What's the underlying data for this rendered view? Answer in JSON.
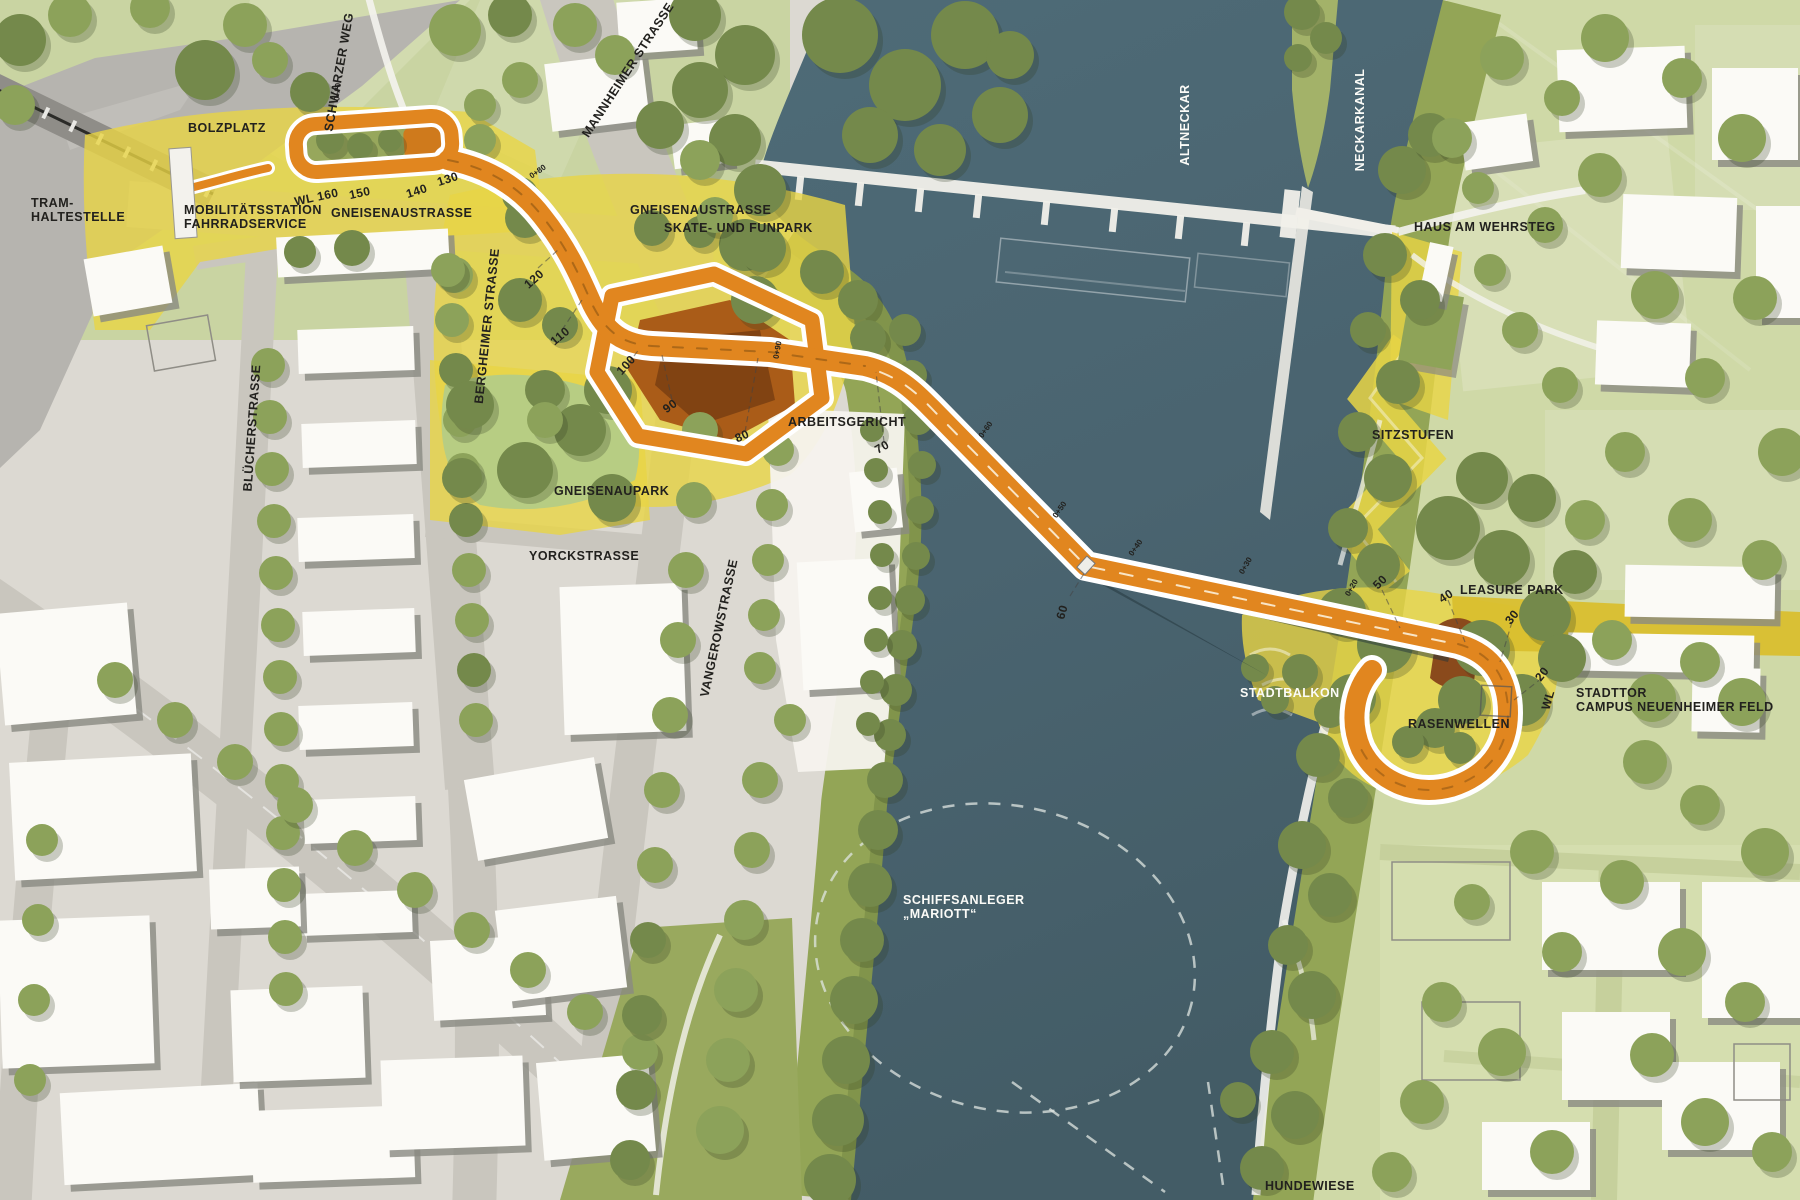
{
  "places": {
    "tram_haltestelle": {
      "line1": "TRAM-",
      "line2": "HALTESTELLE"
    },
    "bolzplatz": {
      "text": "BOLZPLATZ"
    },
    "mobilitaetsstation": {
      "line1": "MOBILITÄTSSTATION",
      "line2": "FAHRRADSERVICE"
    },
    "gneisenaustrasse_west": {
      "text": "GNEISENAUSTRASSE"
    },
    "gneisenaustrasse_east": {
      "text": "GNEISENAUSTRASSE"
    },
    "skate_funpark": {
      "text": "SKATE- UND FUNPARK"
    },
    "schwarzer_weg": {
      "text": "SCHWARZER WEG"
    },
    "mannheimer_strasse": {
      "text": "MANNHEIMER STRASSE"
    },
    "bergheimer_strasse": {
      "text": "BERGHEIMER STRASSE"
    },
    "bluecherstrasse": {
      "text": "BLÜCHERSTRASSE"
    },
    "vangerowstrasse": {
      "text": "VANGEROWSTRASSE"
    },
    "gneisenaupark": {
      "text": "GNEISENAUPARK"
    },
    "yorckstrasse": {
      "text": "YORCKSTRASSE"
    },
    "arbeitsgericht": {
      "text": "ARBEITSGERICHT"
    },
    "altneckar": {
      "text": "ALTNECKAR"
    },
    "neckarkanal": {
      "text": "NECKARKANAL"
    },
    "haus_am_wehrsteg": {
      "text": "HAUS AM WEHRSTEG"
    },
    "sitzstufen": {
      "text": "SITZSTUFEN"
    },
    "leasure_park": {
      "text": "LEASURE PARK"
    },
    "stadtbalkon": {
      "text": "STADTBALKON"
    },
    "rasenwellen": {
      "text": "RASENWELLEN"
    },
    "stadttor_campus": {
      "line1": "STADTTOR",
      "line2": "CAMPUS NEUENHEIMER FELD"
    },
    "schiffsanleger_mariott": {
      "line1": "SCHIFFSANLEGER",
      "line2": "„MARIOTT“"
    },
    "hundewiese": {
      "text": "HUNDEWIESE"
    }
  },
  "chainage": [
    "WL 160",
    "150",
    "140",
    "130",
    "120",
    "110",
    "100",
    "90",
    "80",
    "70",
    "60",
    "50",
    "40",
    "30",
    "20",
    "WL"
  ],
  "survey_marks": [
    "0+70",
    "0+80",
    "0+90",
    "0+60",
    "0+50",
    "0+40",
    "0+30",
    "0+20"
  ],
  "colors": {
    "route_orange": "#e1861f",
    "water_teal": "#4b6570",
    "highlight_yellow": "#e8d545",
    "stadttor_gold": "#d9bf2e",
    "park_green": "#cfd9a7",
    "bank_olive": "#93a556",
    "tree_green": "#8ca25a",
    "skate_bowl_brown": "#a85a1d"
  }
}
